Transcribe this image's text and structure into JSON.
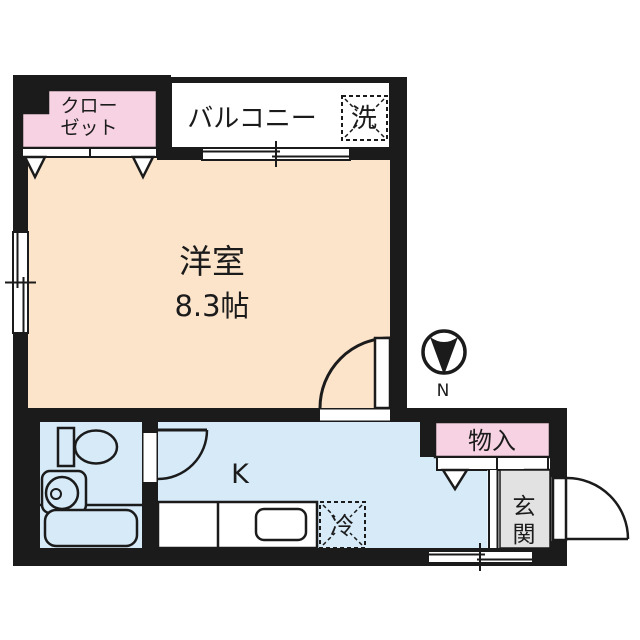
{
  "colors": {
    "wall": "#1b1b1b",
    "room": "#fce4cb",
    "pink": "#f6d2e2",
    "floor": "#d6eaf8",
    "box": "#cde4f5",
    "gray": "#e2e2e2"
  },
  "rooms": {
    "closet": {
      "line1": "クロー",
      "line2": "ゼット"
    },
    "balcony": {
      "label": "バルコニー"
    },
    "washer": {
      "label": "洗"
    },
    "western_room": {
      "name": "洋室",
      "size": "8.3帖"
    },
    "kitchen": {
      "label": "K"
    },
    "fridge": {
      "label": "冷"
    },
    "storage": {
      "label": "物入"
    },
    "entrance": {
      "char1": "玄",
      "char2": "関"
    }
  },
  "compass": {
    "north": "N"
  }
}
